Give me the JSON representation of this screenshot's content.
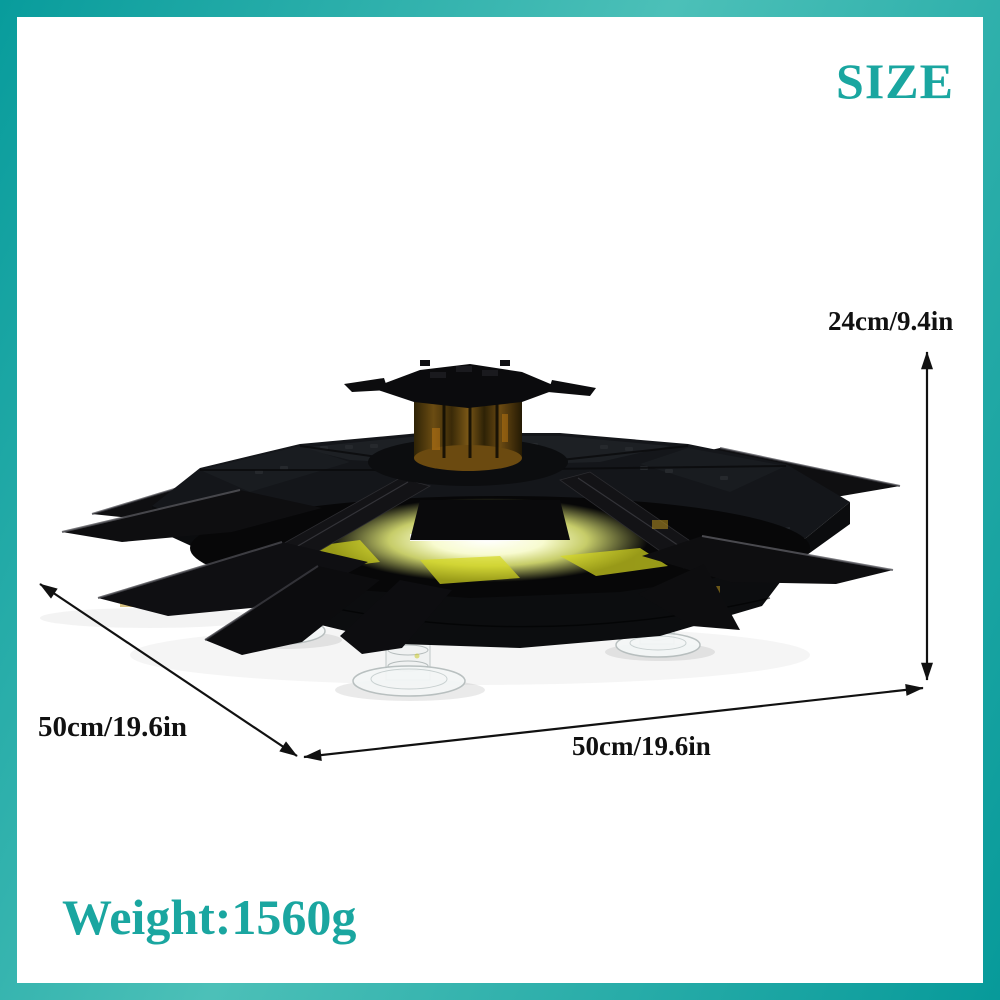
{
  "page": {
    "background": "#ffffff"
  },
  "frame": {
    "color_dark": "#089c9c",
    "color_light": "#4cc0b8",
    "thickness_px": 17
  },
  "header": {
    "title": "SIZE",
    "color": "#1aa6a0"
  },
  "dimensions": {
    "text_color": "#111111",
    "height": {
      "label": "24cm/9.4in"
    },
    "depth": {
      "label": "50cm/19.6in"
    },
    "width": {
      "label": "50cm/19.6in"
    }
  },
  "weight": {
    "label": "Weight:1560g",
    "color": "#1aa6a0"
  },
  "product": {
    "name": "black-brick-ufo-saucer-model",
    "body_color": "#101114",
    "turret_color": "#6b4c12",
    "glow_color": "#eef283",
    "stand_color": "#eef2f2"
  }
}
